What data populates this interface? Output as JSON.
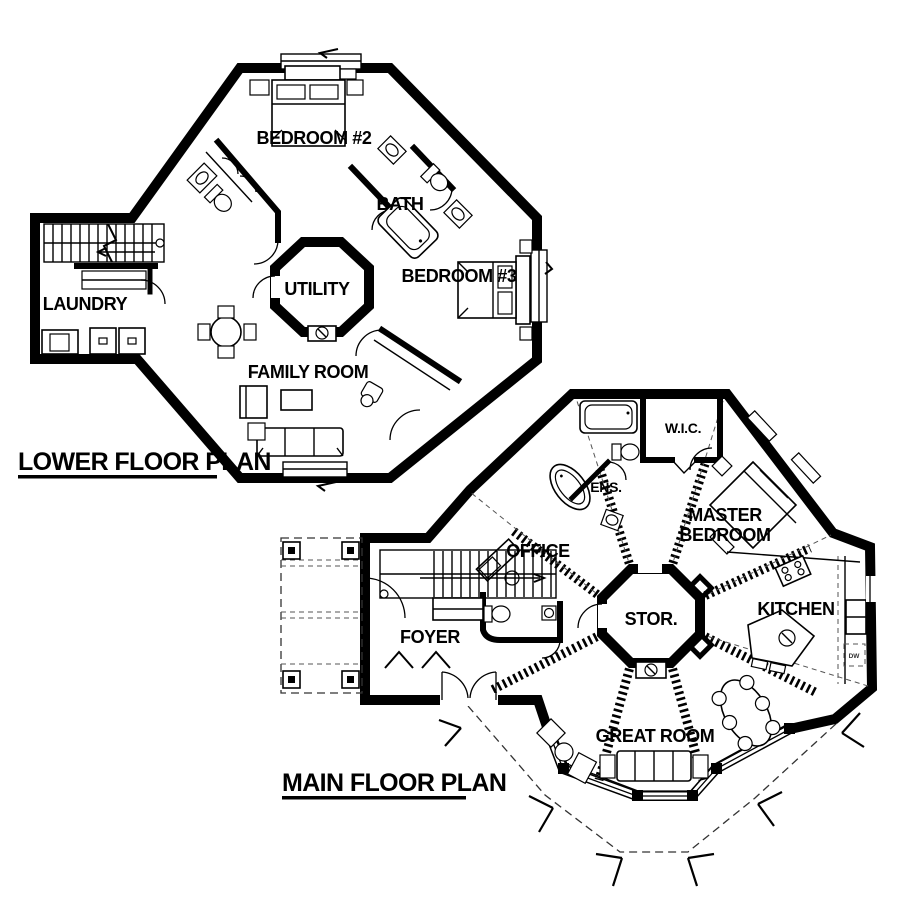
{
  "colors": {
    "ink": "#000000",
    "paper": "#ffffff"
  },
  "lower_plan": {
    "title": "LOWER FLOOR PLAN",
    "rooms": [
      {
        "id": "bedroom-2",
        "label": "BEDROOM #2"
      },
      {
        "id": "bath",
        "label": "BATH"
      },
      {
        "id": "bedroom-3",
        "label": "BEDROOM #3"
      },
      {
        "id": "utility",
        "label": "UTILITY"
      },
      {
        "id": "laundry",
        "label": "LAUNDRY"
      },
      {
        "id": "family-room",
        "label": "FAMILY ROOM"
      }
    ]
  },
  "main_plan": {
    "title": "MAIN FLOOR PLAN",
    "rooms": [
      {
        "id": "wic",
        "label": "W.I.C."
      },
      {
        "id": "ensuite",
        "label": "ENS."
      },
      {
        "id": "master-bedroom",
        "label": "MASTER BEDROOM",
        "lines": [
          "MASTER",
          "BEDROOM"
        ]
      },
      {
        "id": "office",
        "label": "OFFICE"
      },
      {
        "id": "kitchen",
        "label": "KITCHEN"
      },
      {
        "id": "storage",
        "label": "STOR."
      },
      {
        "id": "foyer",
        "label": "FOYER"
      },
      {
        "id": "great-room",
        "label": "GREAT ROOM"
      }
    ],
    "appliance_labels": {
      "dishwasher": "DW"
    }
  }
}
